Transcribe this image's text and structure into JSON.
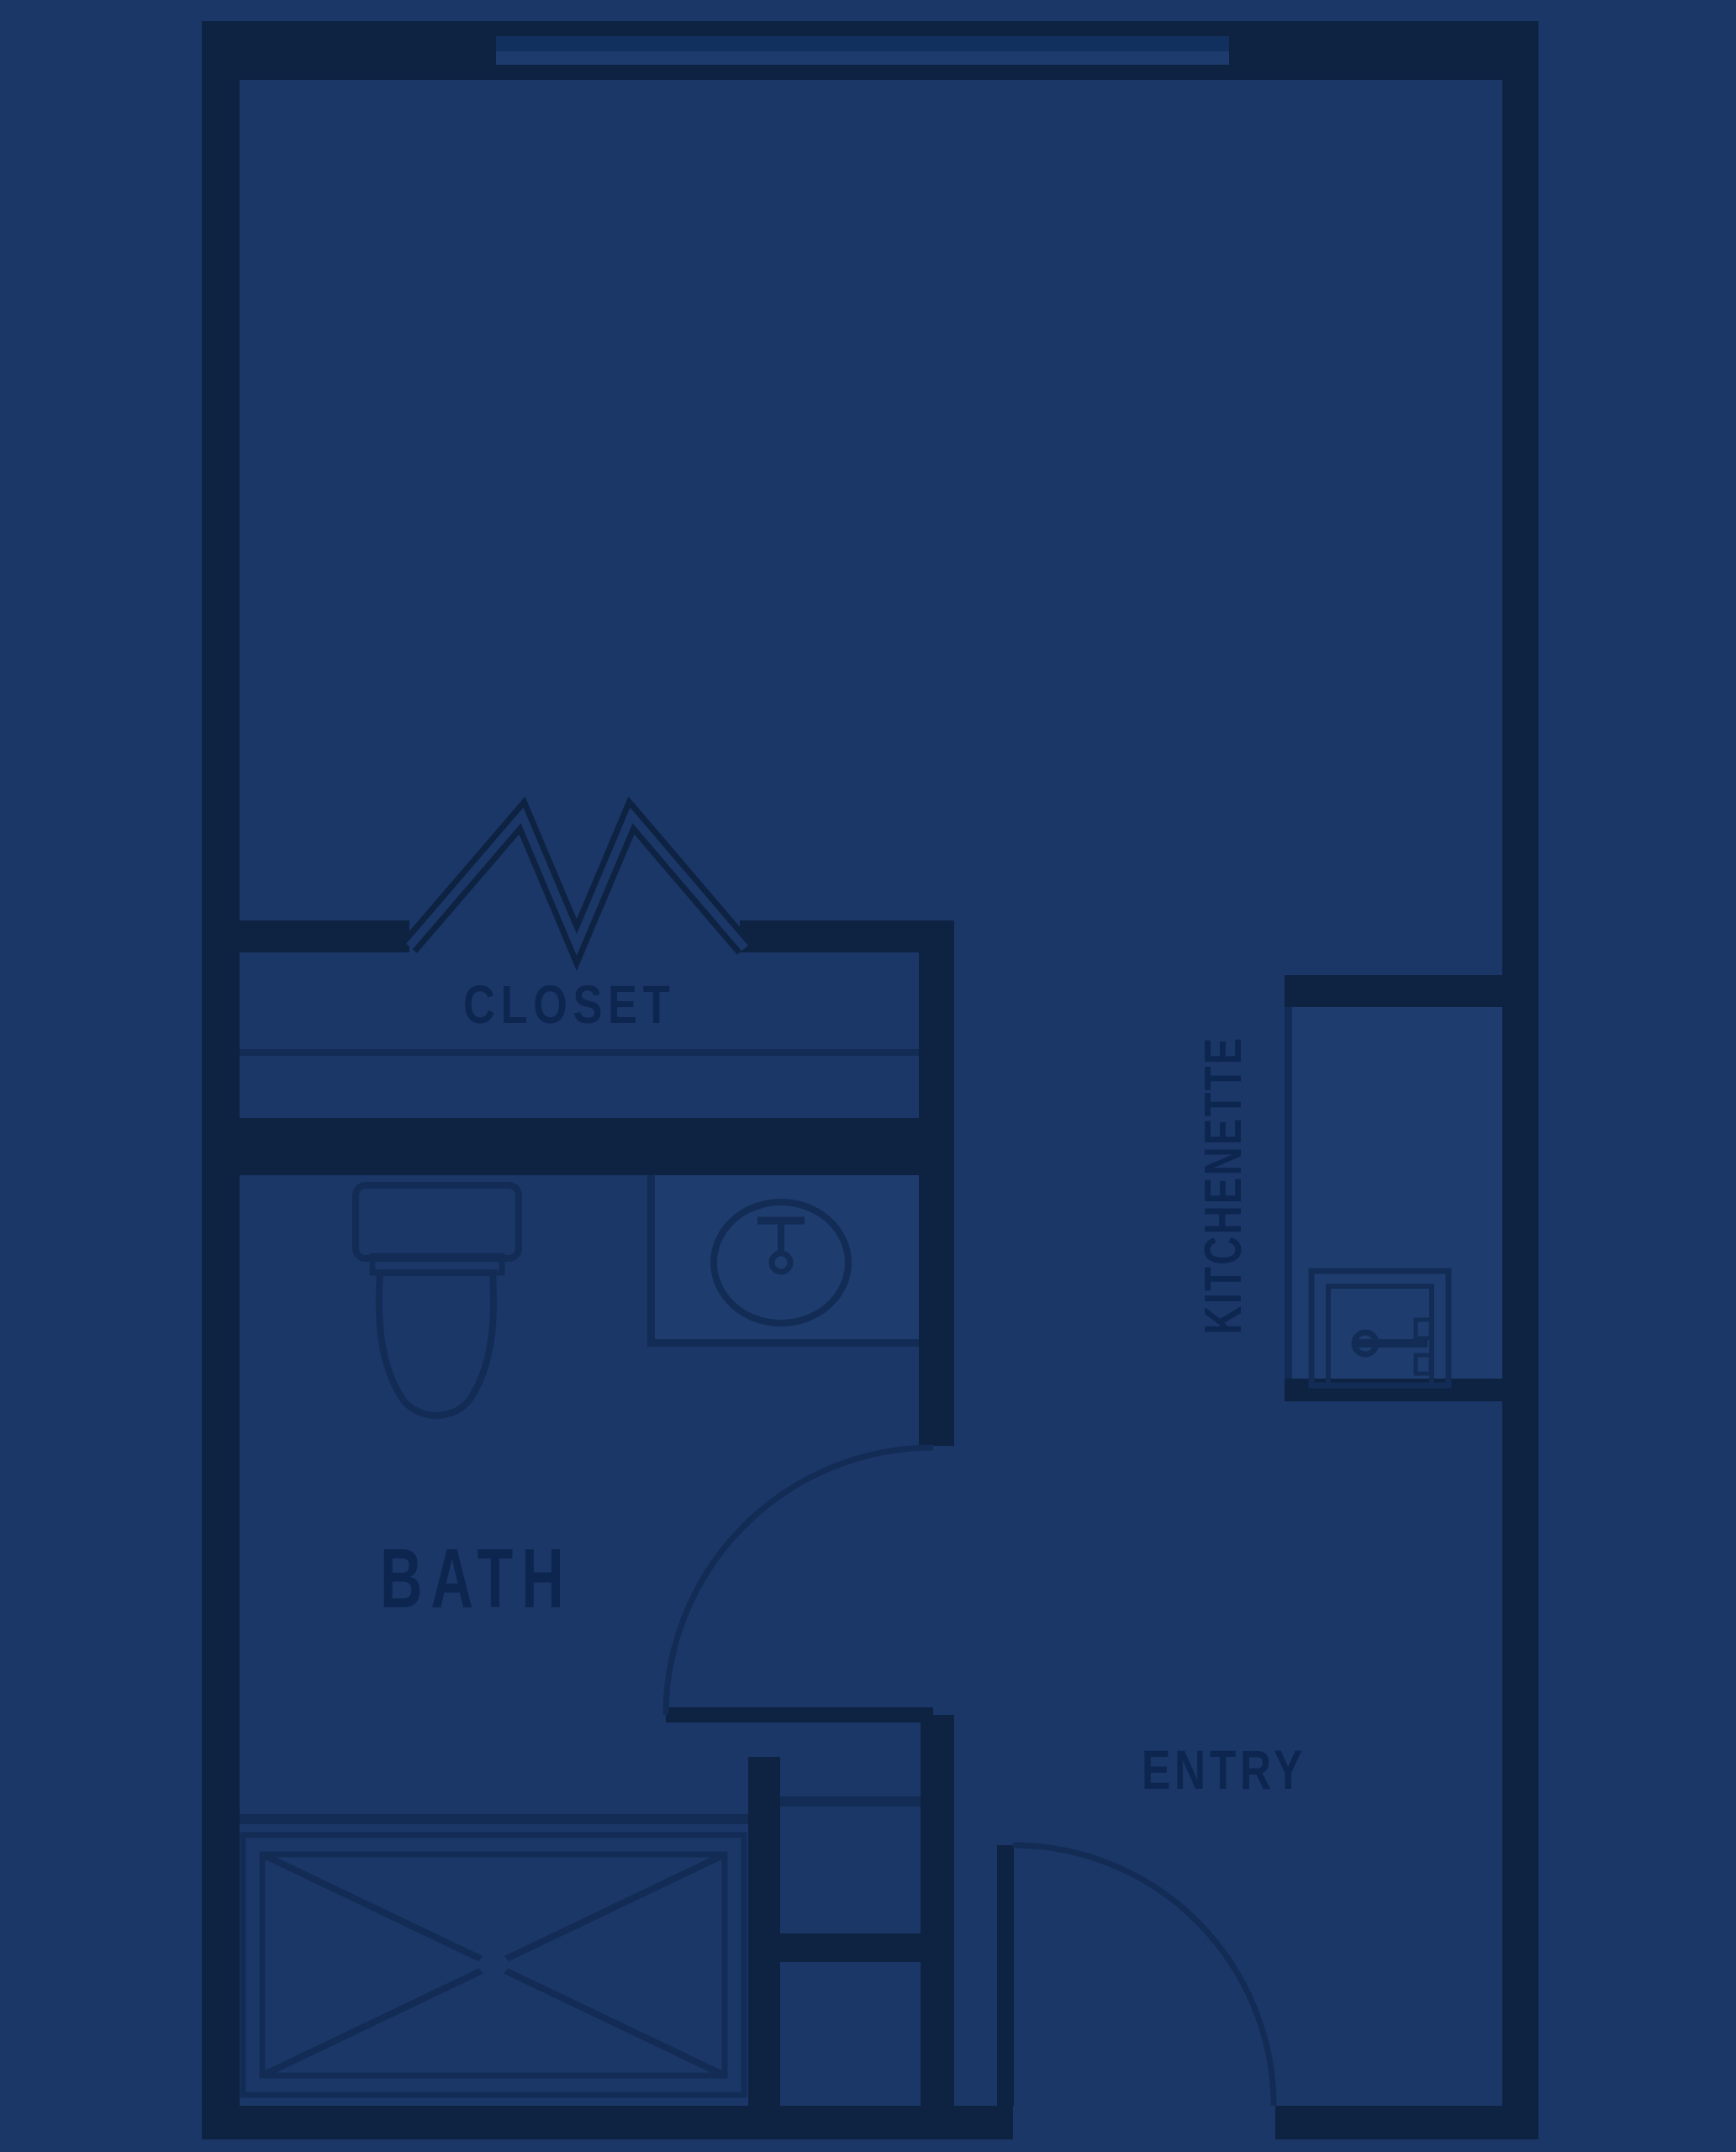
{
  "colors": {
    "background": "#1b3768",
    "wall": "#0e2242",
    "line": "#122c55",
    "surface": "#1e3c6e",
    "text": "#0d2650",
    "glass_upper": "#12305e",
    "glass_lower": "#1d3b6c"
  },
  "rooms": {
    "closet": {
      "label": "CLOSET"
    },
    "bath": {
      "label": "BATH"
    },
    "kitchenette": {
      "label": "KITCHENETTE"
    },
    "entry": {
      "label": "ENTRY"
    }
  },
  "fixtures": {
    "window": "window",
    "closet_rod": "closet-hanger-zigzag",
    "toilet": "toilet",
    "sink": "round-sink-with-faucet",
    "shower": "shower-pan-crossed",
    "refrigerator": "refrigerator-door",
    "bath_door": "bath-door-swing",
    "entry_door": "entry-door-swing"
  }
}
